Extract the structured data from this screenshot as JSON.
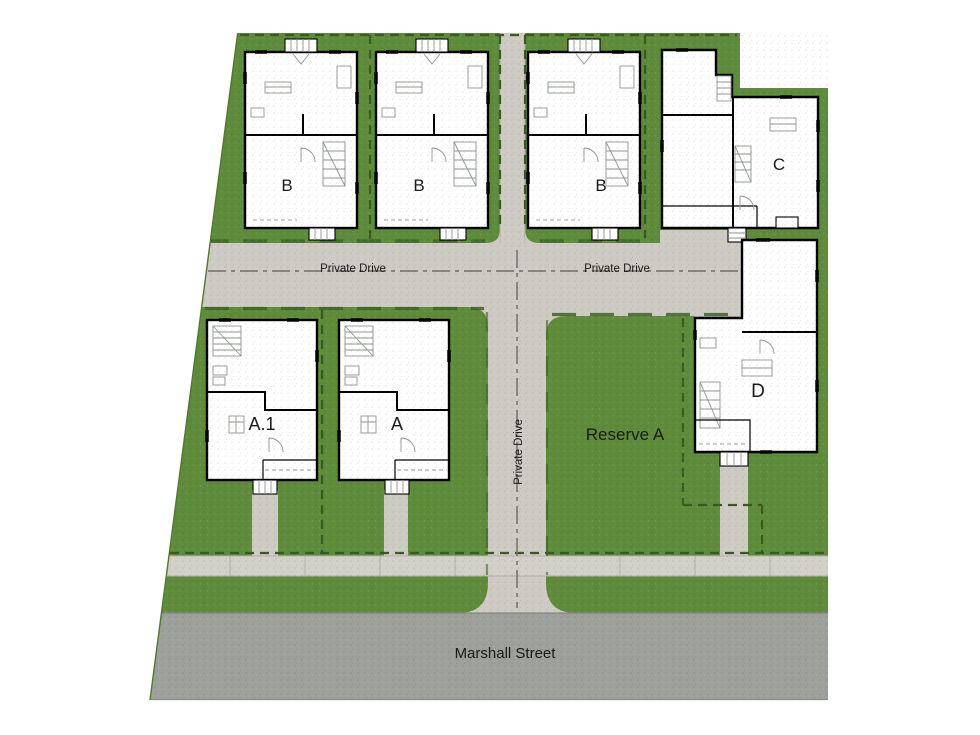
{
  "plan": {
    "units": {
      "b1": "B",
      "b2": "B",
      "b3": "B",
      "c": "C",
      "a1": "A.1",
      "a": "A",
      "d": "D"
    },
    "areas": {
      "reserve": "Reserve A"
    },
    "roads": {
      "private_drive": "Private Drive",
      "marshall": "Marshall Street"
    },
    "colors": {
      "grass": "#5e8c3a",
      "curb_line": "#3b5a21",
      "drive": "#cecbc4",
      "sidewalk": "#d3d0c9",
      "street": "#9da09b",
      "building_fill": "#ffffff",
      "building_outline": "#000000",
      "detail_line": "#8f958f"
    }
  }
}
